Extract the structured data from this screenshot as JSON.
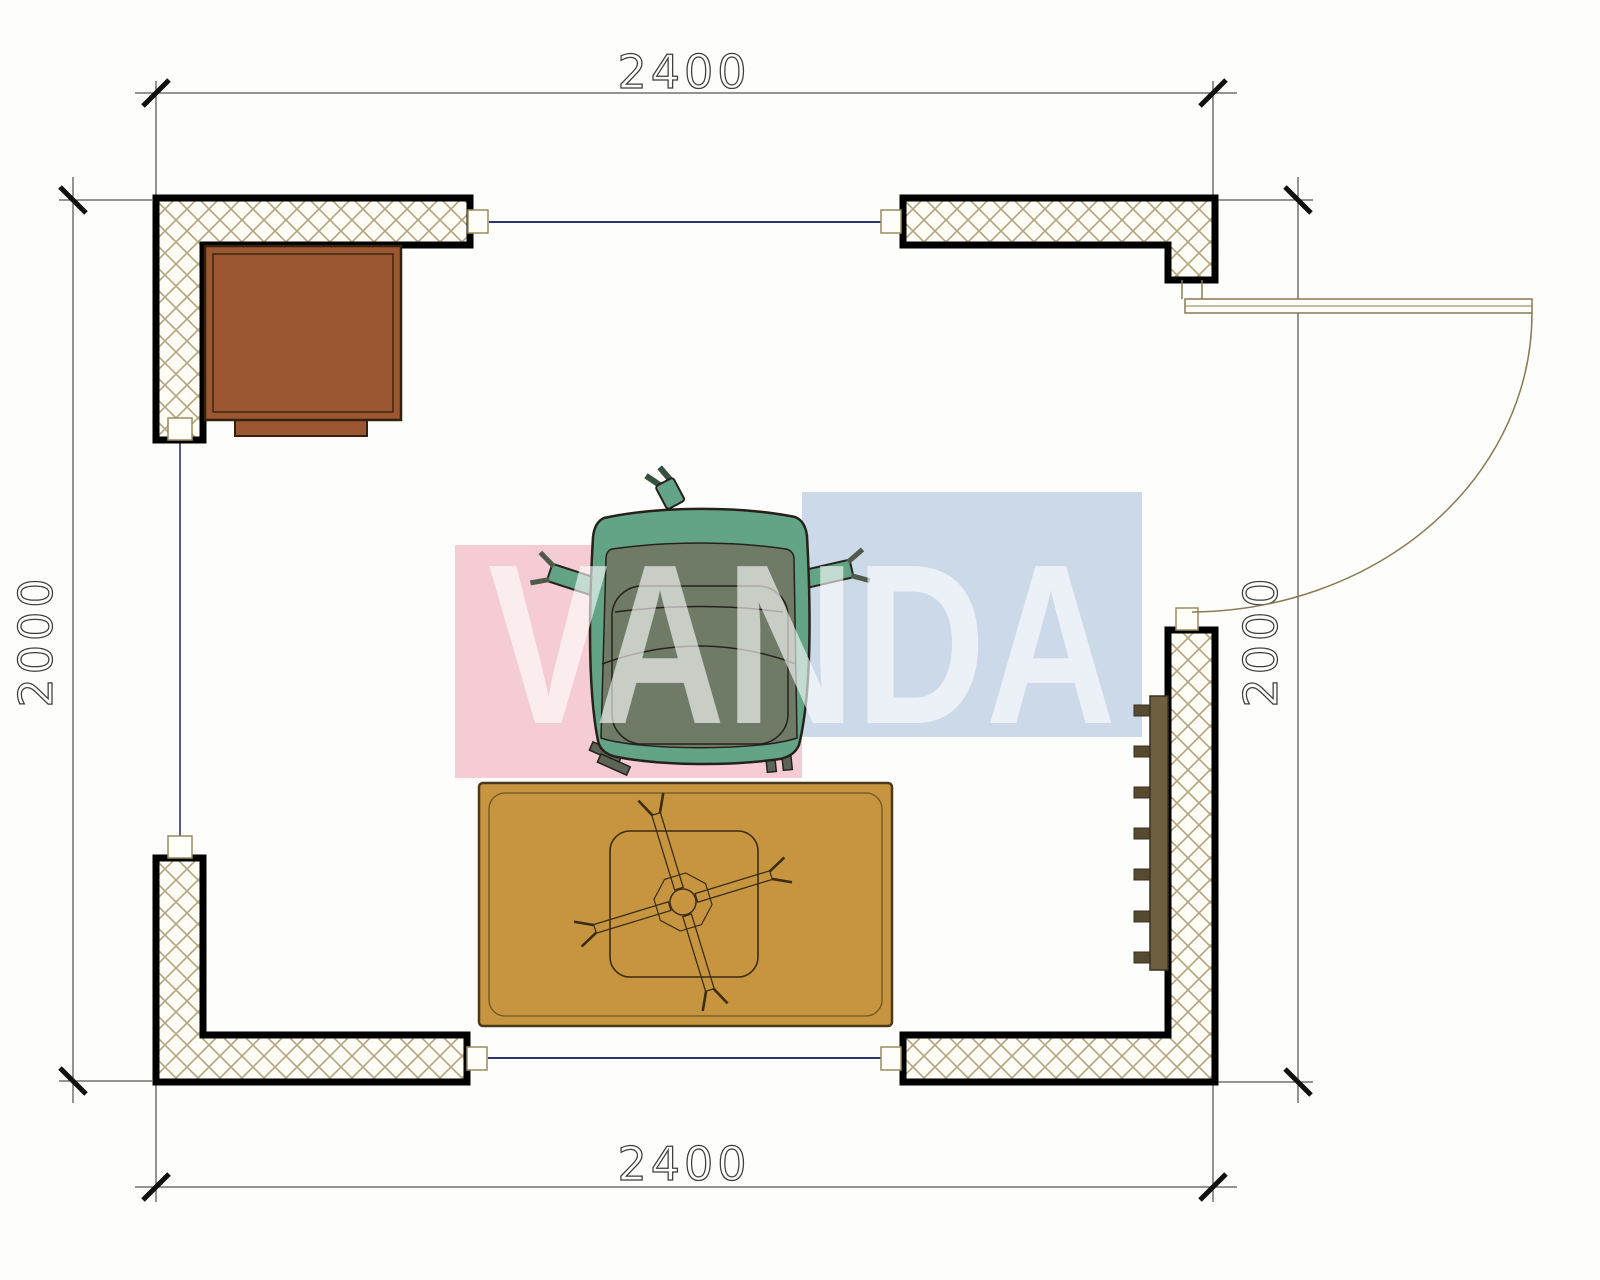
{
  "drawing": {
    "type": "architectural-floor-plan",
    "dimensions": {
      "top": "2400",
      "bottom": "2400",
      "left": "2000",
      "right": "2000"
    },
    "watermark": {
      "text": "VANDA",
      "pink_color": "#f5ccd3",
      "blue_color": "#ccd9e9",
      "text_color": "#ffffff"
    },
    "colors": {
      "background": "#fdfdfc",
      "wall_outline": "#000000",
      "hatch_line": "#b3a47f",
      "hatch_bg": "#fffdf6",
      "window_line": "#2b3570",
      "jamb_border": "#9a8b5e",
      "jamb_fill": "#fffef9",
      "dimension_line": "#2a2a2a",
      "tick": "#111111",
      "door": "#8a7a52",
      "cabinet": "#9b5731",
      "cabinet_outline": "#33200f",
      "rug": "#c79540",
      "rug_outline": "#4a3a1c",
      "table_outline": "#3a2d12",
      "chair_green": "#63a486",
      "chair_olive": "#6f7b66",
      "chair_outline": "#27211b",
      "chair_leg": "#5c6456",
      "radiator": "#6e5f41",
      "radiator_fin": "#564a30",
      "radiator_outline": "#3b3020"
    },
    "symbols": [
      {
        "name": "cabinet-block"
      },
      {
        "name": "armchair-block"
      },
      {
        "name": "rug-block"
      },
      {
        "name": "table-block"
      },
      {
        "name": "radiator-block"
      },
      {
        "name": "door-swing"
      }
    ]
  }
}
